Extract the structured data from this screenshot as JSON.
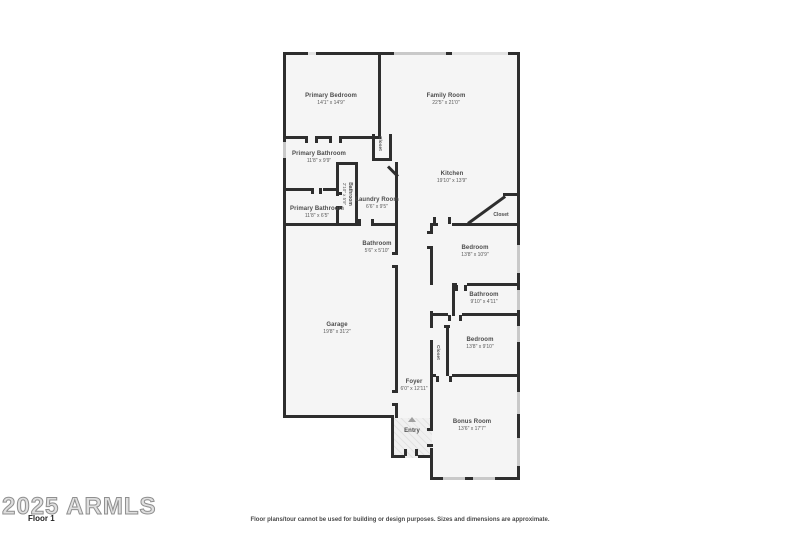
{
  "rooms": {
    "primary_bedroom": {
      "name": "Primary Bedroom",
      "dims": "14'1\" x 14'9\""
    },
    "family_room": {
      "name": "Family Room",
      "dims": "22'5\" x 21'0\""
    },
    "primary_bathroom_1": {
      "name": "Primary Bathroom",
      "dims": "11'8\" x 9'9\""
    },
    "water_closet": {
      "name": "Bathroom",
      "dims": "2'10\" x 5'9\""
    },
    "primary_bathroom_2": {
      "name": "Primary Bathroom",
      "dims": "11'8\" x 6'5\""
    },
    "laundry_room": {
      "name": "Laundry Room",
      "dims": "6'6\" x 9'5\""
    },
    "kitchen": {
      "name": "Kitchen",
      "dims": "19'10\" x 13'9\""
    },
    "kitchen_closet": {
      "name": "Closet"
    },
    "hall_closet": {
      "name": "Closet"
    },
    "hall_bathroom": {
      "name": "Bathroom",
      "dims": "5'6\" x 5'10\""
    },
    "bedroom_2": {
      "name": "Bedroom",
      "dims": "13'8\" x 10'9\""
    },
    "bathroom_2": {
      "name": "Bathroom",
      "dims": "9'10\" x 4'11\""
    },
    "bedroom_3": {
      "name": "Bedroom",
      "dims": "13'8\" x 9'10\""
    },
    "bedroom_closet": {
      "name": "Closet"
    },
    "garage": {
      "name": "Garage",
      "dims": "19'8\" x 31'2\""
    },
    "foyer": {
      "name": "Foyer",
      "dims": "6'0\" x 12'11\""
    },
    "entry": {
      "name": "Entry"
    },
    "bonus_room": {
      "name": "Bonus Room",
      "dims": "13'6\" x 17'7\""
    }
  },
  "icons": {
    "entry_arrow": "triangle-up"
  },
  "footer": {
    "watermark": "2025 ARMLS",
    "floor_label": "Floor 1",
    "disclaimer": "Floor plans/tour cannot be used for building or design purposes. Sizes and dimensions are approximate."
  },
  "colors": {
    "wall": "#2e2e2e",
    "room_fill": "#f5f5f5",
    "window": "#c9c9c9",
    "background": "#ffffff",
    "watermark": "#8f8f8f"
  }
}
